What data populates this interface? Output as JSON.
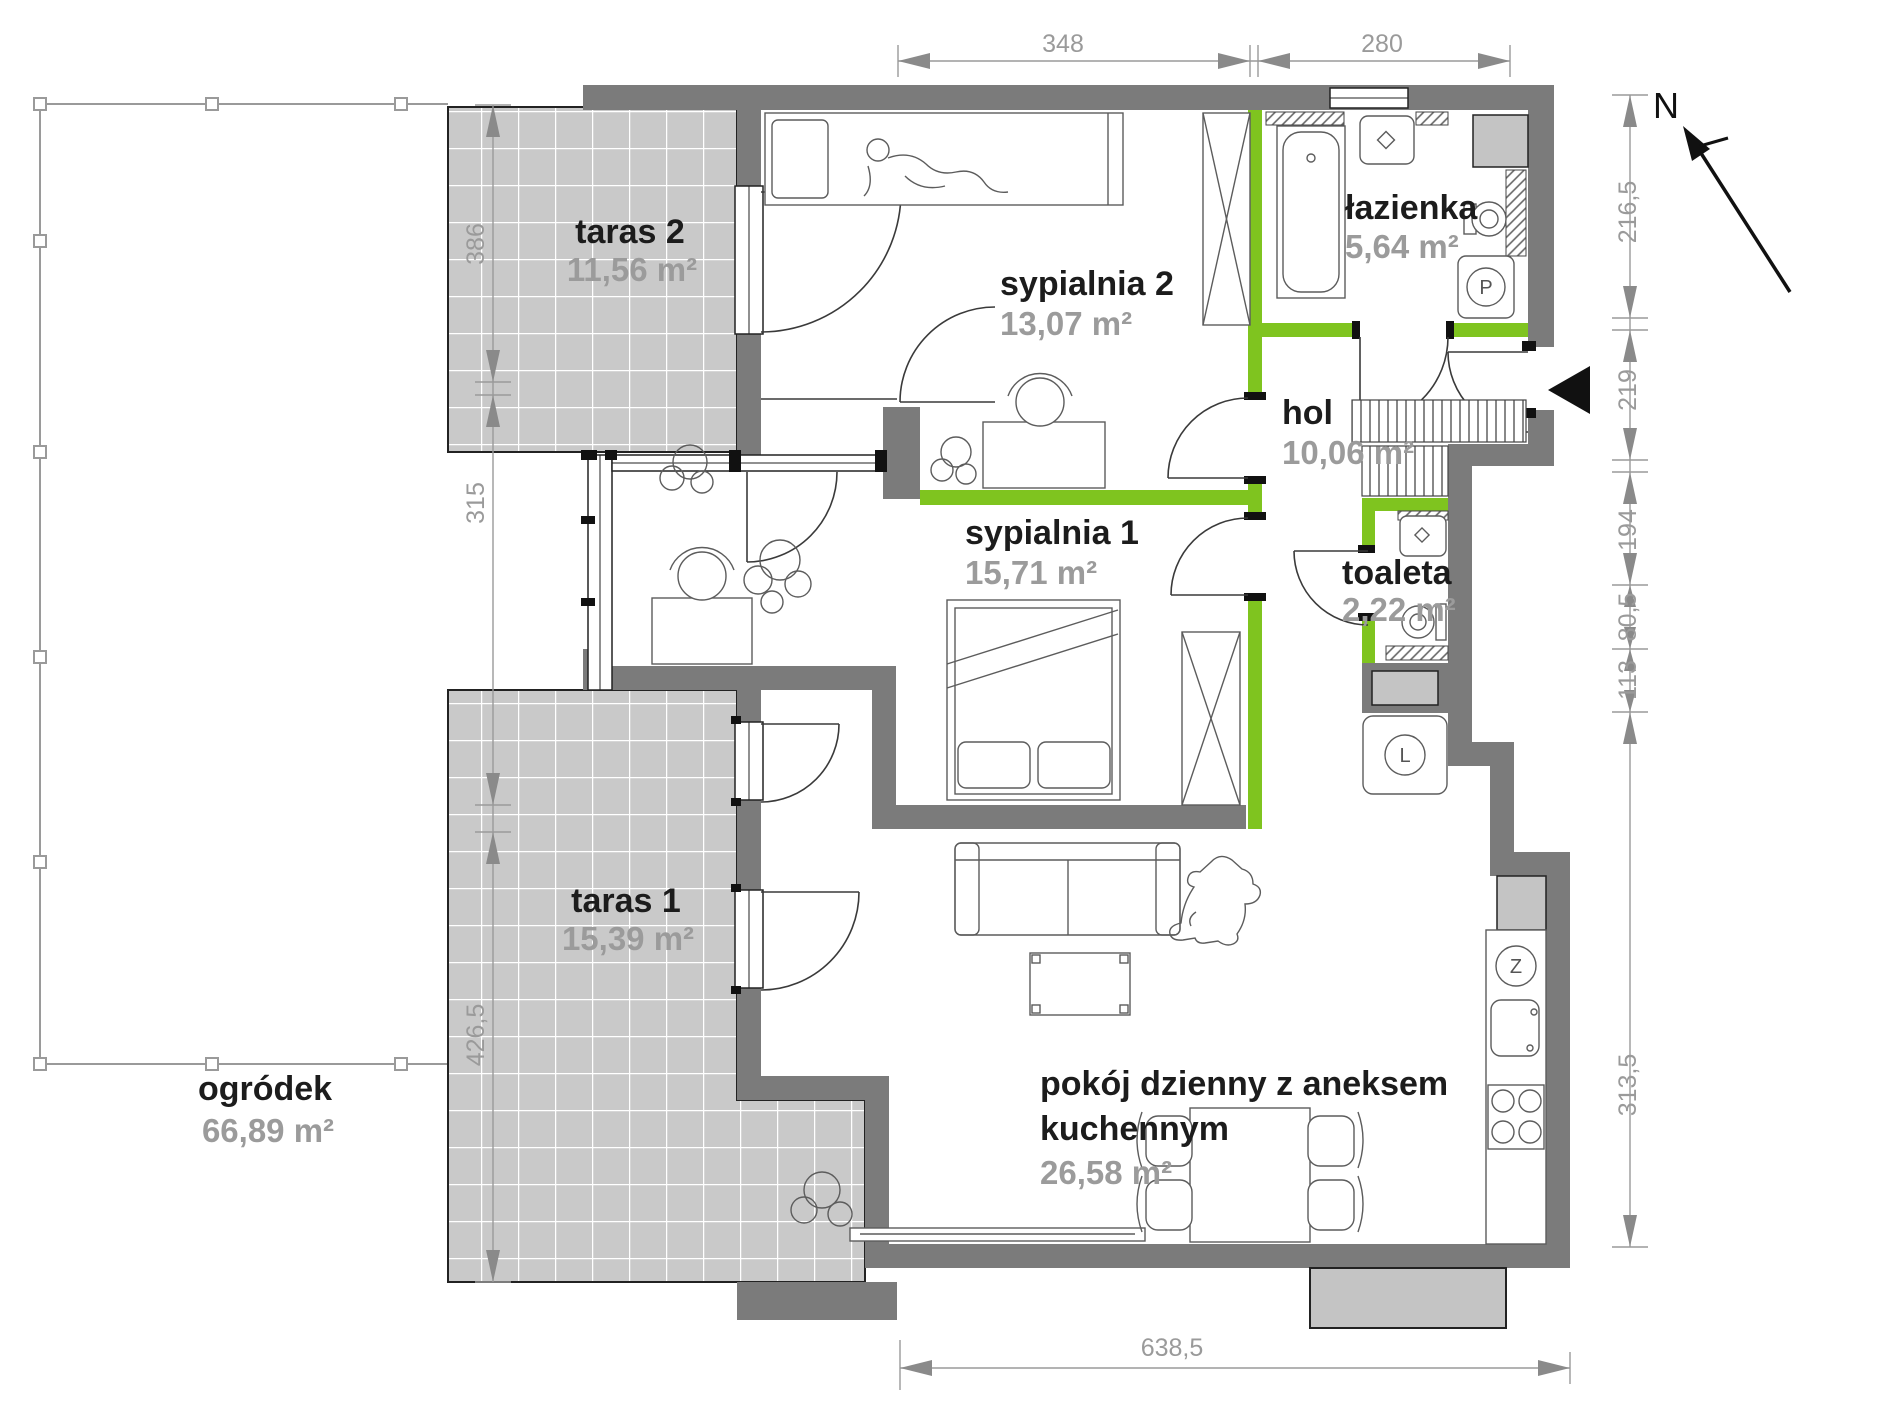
{
  "rooms": [
    {
      "name": "ogródek",
      "area": "66,89 m²"
    },
    {
      "name": "taras 2",
      "area": "11,56 m²"
    },
    {
      "name": "sypialnia 2",
      "area": "13,07 m²"
    },
    {
      "name": "łazienka",
      "area": "5,64 m²"
    },
    {
      "name": "hol",
      "area": "10,06 m²"
    },
    {
      "name": "sypialnia 1",
      "area": "15,71 m²"
    },
    {
      "name": "toaleta",
      "area": "2,22 m²"
    },
    {
      "name": "taras 1",
      "area": "15,39 m²"
    },
    {
      "name": "pokój dzienny z aneksem kuchennym",
      "lines": [
        "pokój dzienny z aneksem",
        "kuchennym"
      ],
      "area": "26,58 m²"
    }
  ],
  "dims": {
    "top": [
      "348",
      "280"
    ],
    "left": [
      "386",
      "315",
      "426,5"
    ],
    "right": [
      "216,5",
      "219",
      "194",
      "80,5",
      "113",
      "313,5"
    ],
    "bottom": [
      "638,5"
    ]
  },
  "compass": {
    "north": "N"
  },
  "appliances": {
    "fridge_label": "L",
    "dishwasher_label": "Z",
    "washer_label": "P"
  },
  "colors": {
    "exterior_wall": "#7b7b7b",
    "interior_wall": "#7fc41f",
    "terrace_tile": "#c9c9c9",
    "terrace_grout": "#ffffff",
    "shaft_fill": "#c4c4c4",
    "dim_text": "#9a9a9a",
    "room_name": "#1c1c1c",
    "room_area": "#9b9b9b"
  }
}
